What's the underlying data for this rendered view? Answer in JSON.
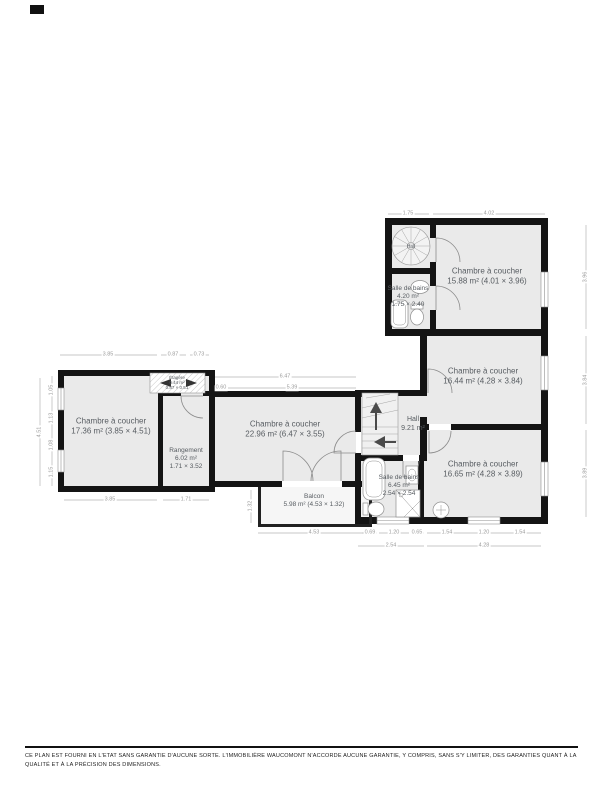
{
  "colors": {
    "wall": "#141414",
    "floor": "#eaeaea",
    "dimension": "#9b9b9b",
    "label": "#575c61"
  },
  "plan": {
    "rooms": {
      "bedroom_top_right": {
        "name": "Chambre à coucher",
        "info": "15.88 m² (4.01 × 3.96)"
      },
      "bathroom_top": {
        "name": "Salle de bains",
        "area": "4.20 m²",
        "size": "1.75 × 2.40"
      },
      "spiral_stair_label": "Hall",
      "bedroom_mid_right": {
        "name": "Chambre à coucher",
        "info": "16.44 m² (4.28 × 3.84)"
      },
      "bedroom_left": {
        "name": "Chambre à coucher",
        "info": "17.36 m² (3.85 × 4.51)"
      },
      "storage": {
        "name": "Rangement",
        "area": "6.02 m²",
        "size": "1.71 × 3.52"
      },
      "shelf_closet": {
        "name": "Étagère",
        "area": "0.44 m²",
        "size": "0.87 × 0.51"
      },
      "bedroom_center": {
        "name": "Chambre à coucher",
        "info": "22.96 m² (6.47 × 3.55)"
      },
      "hall": {
        "name": "Hall",
        "area": "9.21 m²"
      },
      "bedroom_bottom_right": {
        "name": "Chambre à coucher",
        "info": "16.65 m² (4.28 × 3.89)"
      },
      "bathroom_bottom": {
        "name": "Salle de bains",
        "area": "6.45 m²",
        "size": "2.54 × 2.54"
      },
      "balcony": {
        "name": "Balcon",
        "info": "5.98 m² (4.53 × 1.32)"
      }
    },
    "dimensions": {
      "top_stair": "1.75",
      "top_bedroom": "4.02",
      "tl_bedroom": "3.85",
      "tl_closet_a": "0.87",
      "tl_closet_b": "0.73",
      "center_total": "6.47",
      "center_jog": "0.60",
      "center_inner": "5.39",
      "balcony_width": "4.53",
      "balcony_depth": "1.32",
      "bath_b1": "0.69",
      "bath_b2": "1.20",
      "bath_b3": "0.65",
      "bath_total": "2.54",
      "br_b1": "1.54",
      "br_b2": "1.20",
      "br_b3": "1.54",
      "br_total": "4.28",
      "bl_bedroom": "3.85",
      "bl_storage": "1.71",
      "left_total": "4.51",
      "left_s1": "1.05",
      "left_s2": "1.13",
      "left_s3": "1.08",
      "left_s4": "1.15",
      "right_top_total": "3.96",
      "right_mid_total": "3.84",
      "right_bottom_total": "3.89"
    }
  },
  "footer": {
    "disclaimer": "CE PLAN EST FOURNI EN L'ETAT SANS GARANTIE D'AUCUNE SORTE. L'IMMOBILIÈRE WAUCOMONT N'ACCORDE AUCUNE GARANTIE, Y COMPRIS, SANS S'Y LIMITER, DES GARANTIES QUANT À LA QUALITÉ ET À LA PRÉCISION DES DIMENSIONS."
  }
}
